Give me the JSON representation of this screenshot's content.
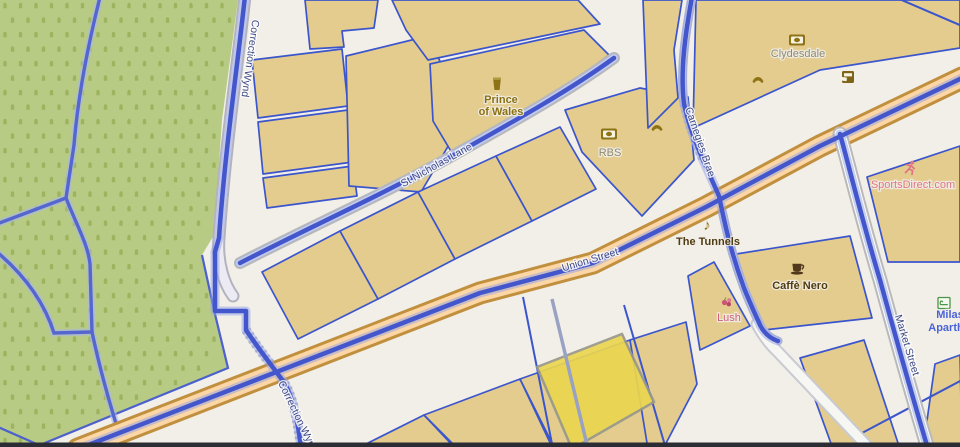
{
  "streets": {
    "correction_wynd_upper": "Correction Wynd",
    "correction_wynd_lower": "Correction Wynd",
    "st_nicholas_lane": "St Nicholas Lane",
    "union_street": "Union Street",
    "carnegies_brae": "Carnegies Brae",
    "market_street": "Market Street"
  },
  "pois": {
    "prince_of_wales_line1": "Prince",
    "prince_of_wales_line2": "of Wales",
    "rbs": "RBS",
    "clydesdale": "Clydesdale",
    "the_tunnels": "The Tunnels",
    "caffe_nero": "Caffè Nero",
    "lush": "Lush",
    "sportsdirect": "SportsDirect.com",
    "milas_line1": "Milas",
    "milas_line2": "Aparth"
  },
  "icons": {
    "prince_of_wales": "beer-icon",
    "rbs": [
      "bank-icon",
      "phone-icon"
    ],
    "clydesdale": [
      "bank-icon",
      "phone-icon",
      "atm-icon"
    ],
    "the_tunnels": "music-note-icon",
    "caffe_nero": "coffee-cup-icon",
    "lush": "cosmetics-icon",
    "sportsdirect": "runner-icon",
    "milas": "hotel-bed-icon"
  },
  "colors": {
    "background": "#f2efe9",
    "building_fill": "#e3cc8d",
    "building_border": "#3b55cc",
    "route_highlight_blue": "#4456cc",
    "primary_road_fill": "#fcd6a4",
    "primary_road_casing": "#c0903f",
    "cemetery_green": "#b7cb85",
    "grave_symbol_green": "#9eb35e",
    "selected_building_yellow": "#ead64f",
    "poi_brown": "#8e7316",
    "poi_dark_brown": "#503c11",
    "poi_pink": "#ce5f7d",
    "poi_salmon": "#df7387",
    "poi_blue": "#4a63d8"
  }
}
